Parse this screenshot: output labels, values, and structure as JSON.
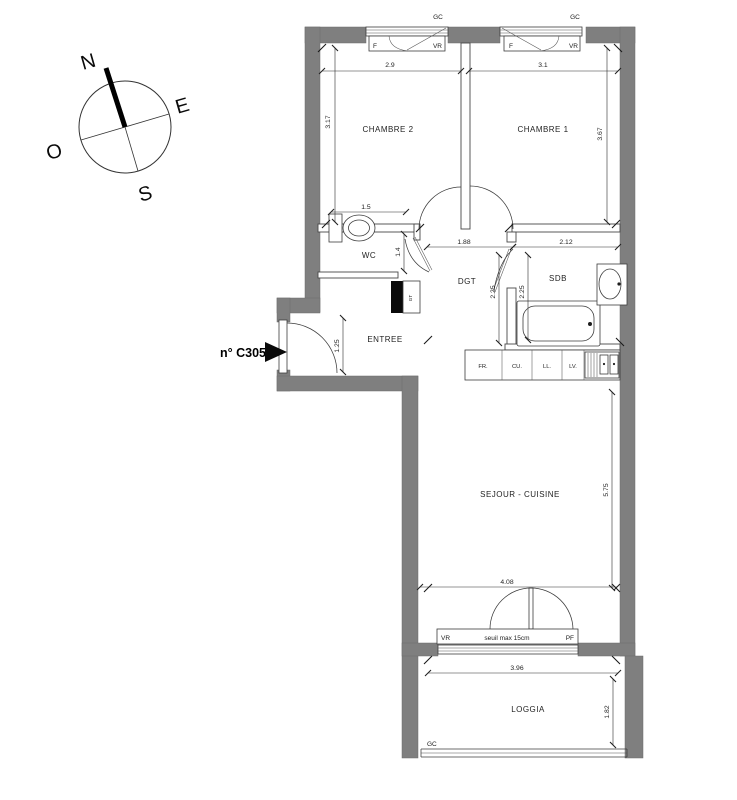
{
  "unit": {
    "label": "n° C305"
  },
  "compass": {
    "north": "N",
    "east": "E",
    "south": "S",
    "west": "O"
  },
  "rooms": {
    "chambre2": "CHAMBRE 2",
    "chambre1": "CHAMBRE 1",
    "wc": "WC",
    "dgt": "DGT",
    "sdb": "SDB",
    "entree": "ENTREE",
    "sejour_cuisine": "SEJOUR - CUISINE",
    "loggia": "LOGGIA"
  },
  "openings": {
    "gc": "GC",
    "f": "F",
    "vr": "VR",
    "pf": "PF",
    "seuil": "seuil max 15cm",
    "duct": "GT"
  },
  "kitchen": {
    "fr": "FR.",
    "cu": "CU.",
    "ll": "LL.",
    "lv": "LV."
  },
  "dims": {
    "chambre2_w": "2.9",
    "chambre1_w": "3.1",
    "chambre2_h": "3.17",
    "chambre1_h": "3.67",
    "wc_w": "1.5",
    "wc_h": "1.4",
    "dgt_w": "1.88",
    "sdb_w": "2.12",
    "dgt_h": "2.25",
    "sdb_h": "2.25",
    "entree_h": "1.25",
    "sejour_h": "5.75",
    "sejour_w": "4.08",
    "loggia_w": "3.96",
    "loggia_h": "1.82"
  },
  "colors": {
    "wall": "#7f7f7f",
    "line": "#3c3c3c"
  }
}
